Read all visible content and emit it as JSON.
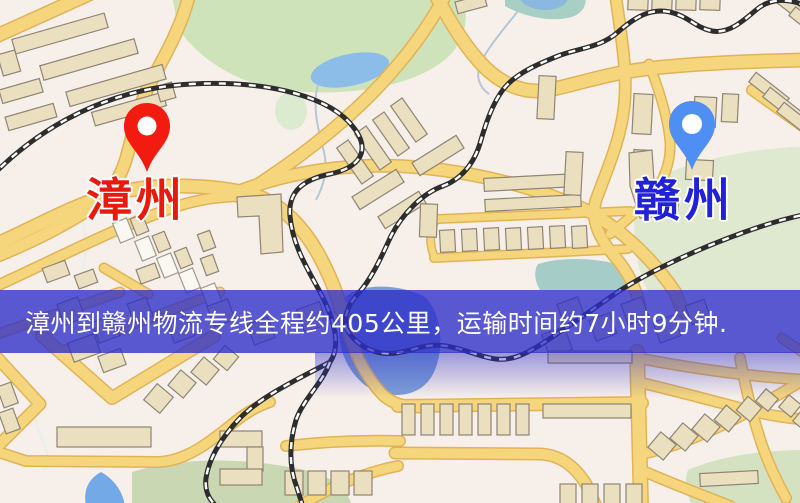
{
  "map": {
    "markers": [
      {
        "role": "origin",
        "city": "漳州",
        "pin_color": "#f31b10",
        "label_color": "#e8190d"
      },
      {
        "role": "destination",
        "city": "赣州",
        "pin_color": "#4f8ef3",
        "label_color": "#2121d8"
      }
    ]
  },
  "banner": {
    "text": "漳州到赣州物流专线全程约405公里，运输时间约7小时9分钟.",
    "background_color": "#5b5bd0",
    "text_color": "#ffffff",
    "route": {
      "origin": "漳州",
      "destination": "赣州",
      "service_type": "物流专线",
      "distance_text": "全程约405公里",
      "distance_km": 405,
      "duration_text": "运输时间约7小时9分钟",
      "duration_hours": 7,
      "duration_minutes": 9
    }
  }
}
